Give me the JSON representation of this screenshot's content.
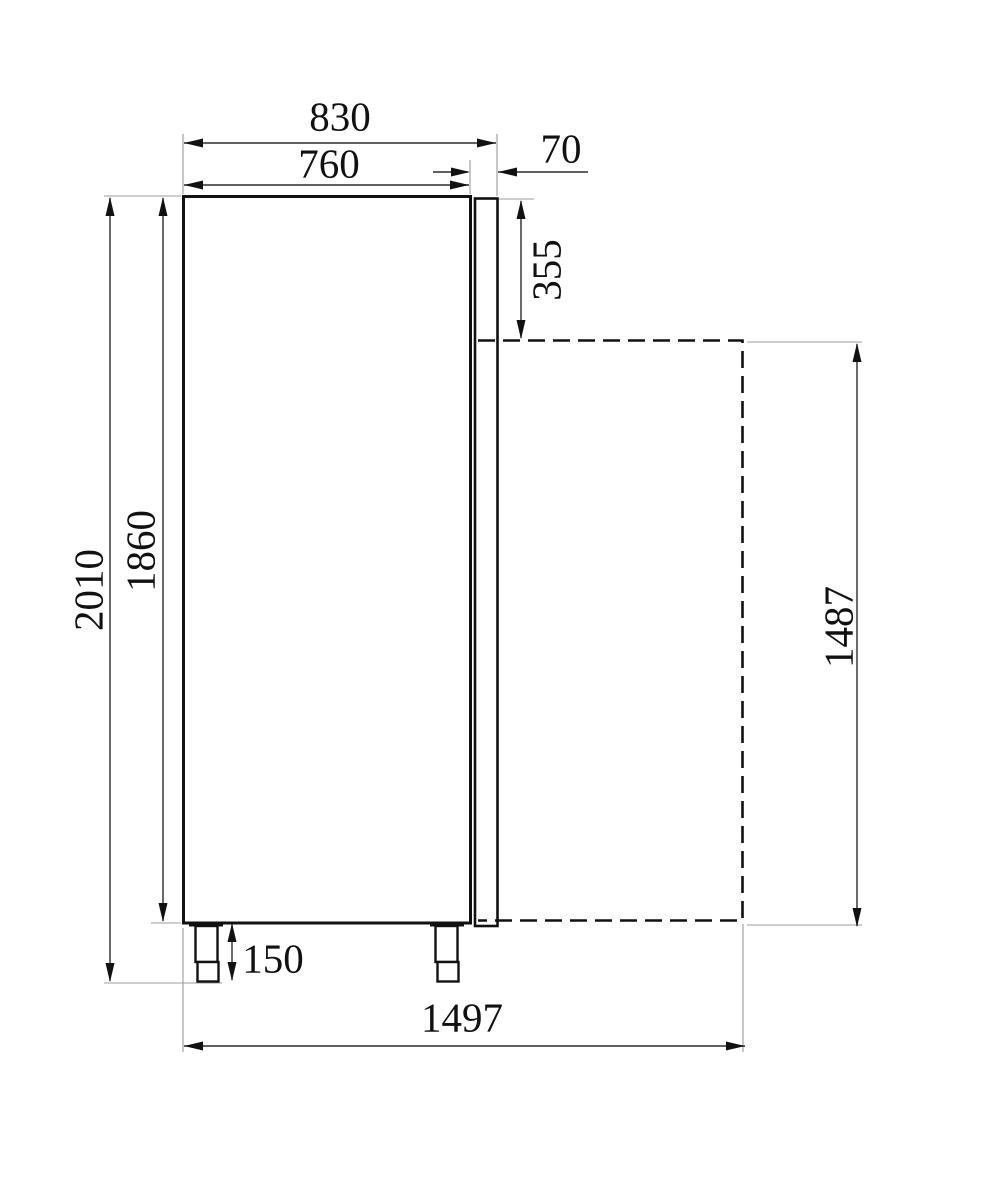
{
  "colors": {
    "object_line": "#111111",
    "dimension_line": "#2b2b2b",
    "extension_line": "#9c9c9c",
    "text": "#111111",
    "background": "#ffffff"
  },
  "dimensions": {
    "total_depth": "830",
    "body_depth": "760",
    "door_thickness": "70",
    "door_top_offset": "355",
    "total_height": "2010",
    "body_height": "1860",
    "feet_height": "150",
    "depth_door_open": "1497",
    "door_height": "1487"
  }
}
